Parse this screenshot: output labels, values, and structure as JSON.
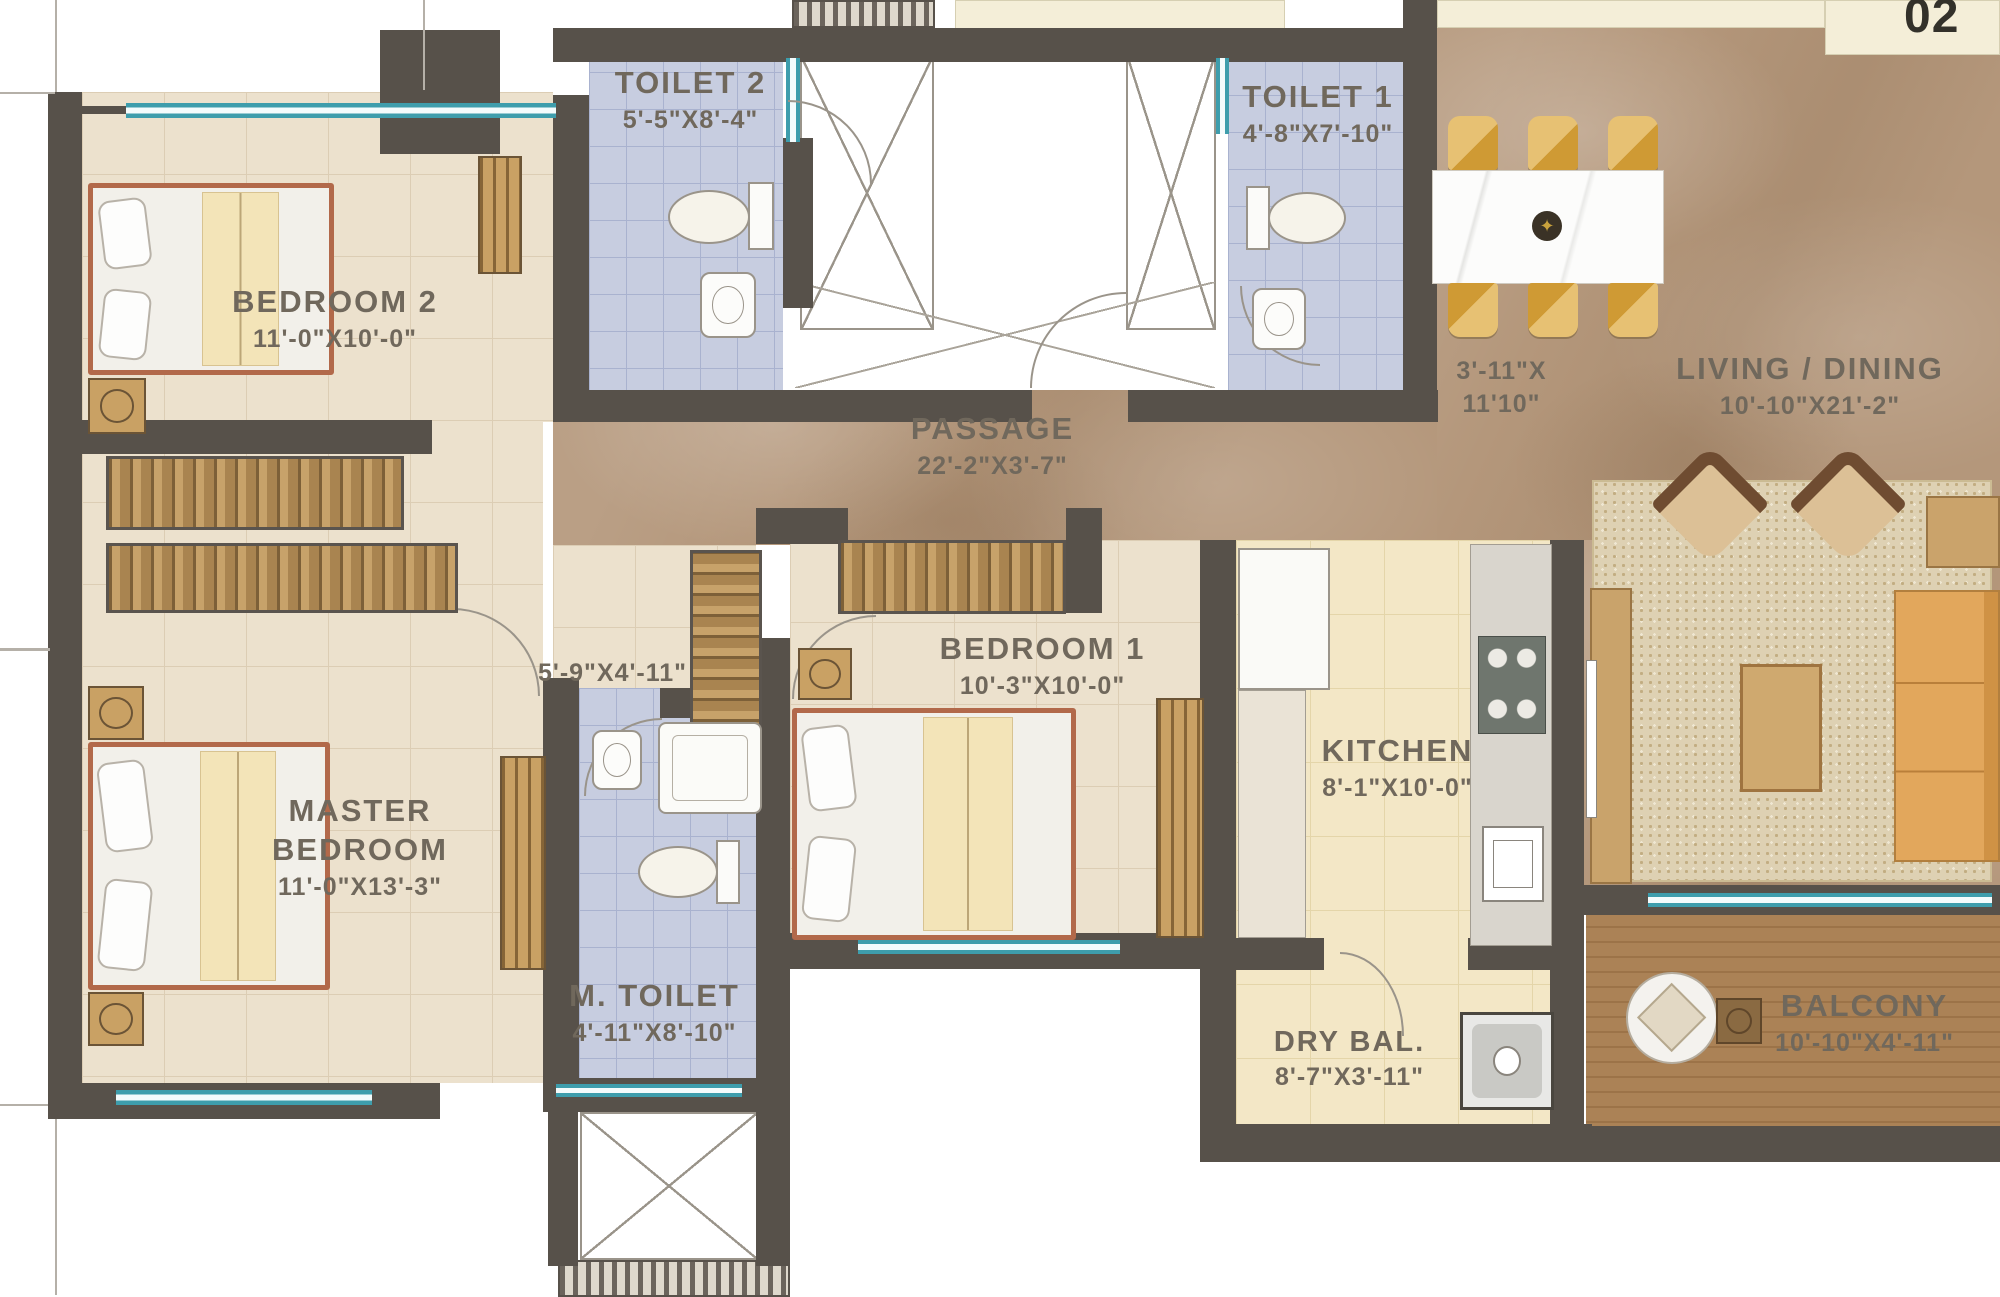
{
  "unit_number": "02",
  "rooms": {
    "bedroom2": {
      "name": "BEDROOM 2",
      "dims": "11'-0\"X10'-0\""
    },
    "toilet2": {
      "name": "TOILET 2",
      "dims": "5'-5\"X8'-4\""
    },
    "toilet1": {
      "name": "TOILET 1",
      "dims": "4'-8\"X7'-10\""
    },
    "passage": {
      "name": "PASSAGE",
      "dims": "22'-2\"X3'-7\""
    },
    "living_dining": {
      "name": "LIVING / DINING",
      "dims": "10'-10\"X21'-2\""
    },
    "dining_area": {
      "dims1": "3'-11\"X",
      "dims2": "11'10\""
    },
    "master_bedroom": {
      "name1": "MASTER",
      "name2": "BEDROOM",
      "dims": "11'-0\"X13'-3\""
    },
    "foyer": {
      "dims": "5'-9\"X4'-11\""
    },
    "bedroom1": {
      "name": "BEDROOM 1",
      "dims": "10'-3\"X10'-0\""
    },
    "kitchen": {
      "name": "KITCHEN",
      "dims": "8'-1\"X10'-0\""
    },
    "m_toilet": {
      "name": "M. TOILET",
      "dims": "4'-11\"X8'-10\""
    },
    "dry_balcony": {
      "name": "DRY BAL.",
      "dims": "8'-7\"X3'-11\""
    },
    "balcony": {
      "name": "BALCONY",
      "dims": "10'-10\"X4'-11\""
    }
  },
  "palette": {
    "wall": "#57514a",
    "window_teal": "#3e9dac",
    "bedroom_floor": "#ece1cd",
    "toilet_floor": "#c7cde0",
    "marble_floor": "#b4977b",
    "kitchen_floor": "#f3e7c6",
    "balcony_wood": "#a87e50",
    "bed_frame": "#b2694a",
    "dining_gold": "#d9a94e",
    "label_text": "#70685c"
  },
  "icons": {
    "center_dec": "✦"
  }
}
